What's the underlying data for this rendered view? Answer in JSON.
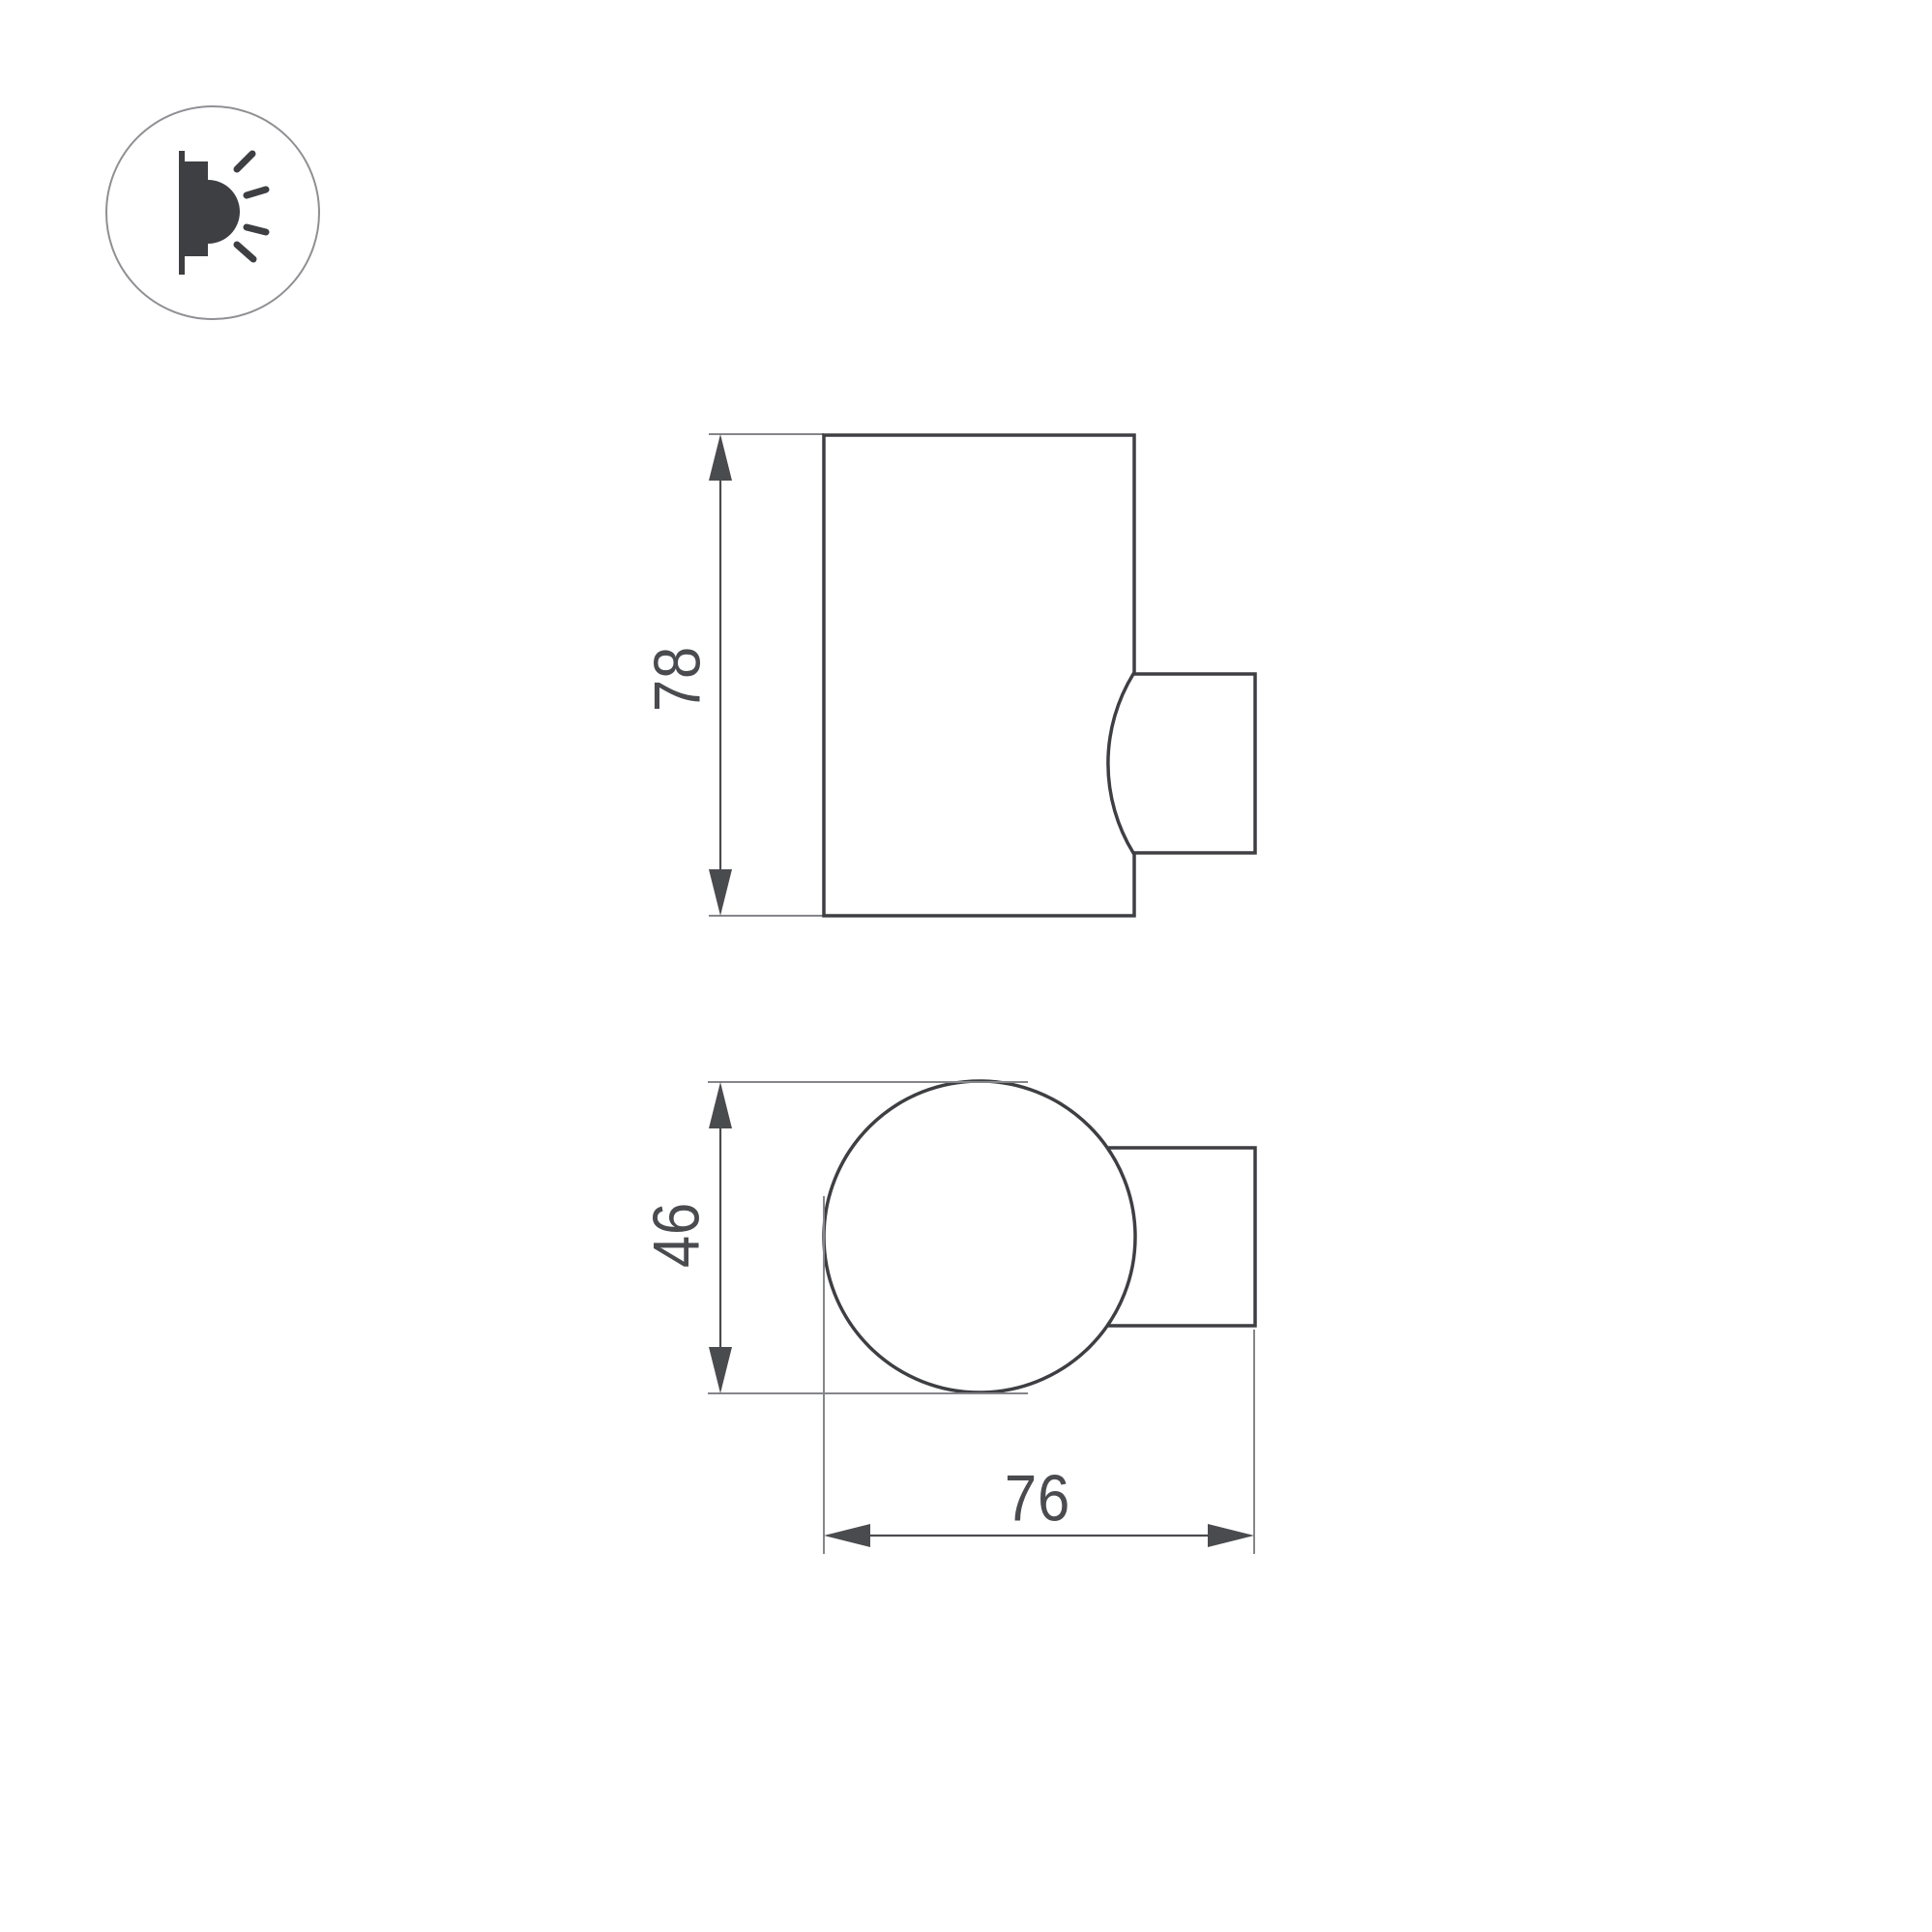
{
  "title": "Wall luminaire dimensional drawing",
  "icon": {
    "name": "wall-mounted-light-glow-icon"
  },
  "views": {
    "side": {
      "height_label": "78"
    },
    "top": {
      "diameter_label": "46",
      "depth_label": "76"
    }
  },
  "colors": {
    "line-main": "#3e3f43",
    "line-dim": "#4a4b4f",
    "line-ext": "#85868a",
    "text": "#4a4b4f",
    "icon-ink": "#3e3f43",
    "icon-ring": "#8f9094",
    "bg": "#ffffff"
  }
}
